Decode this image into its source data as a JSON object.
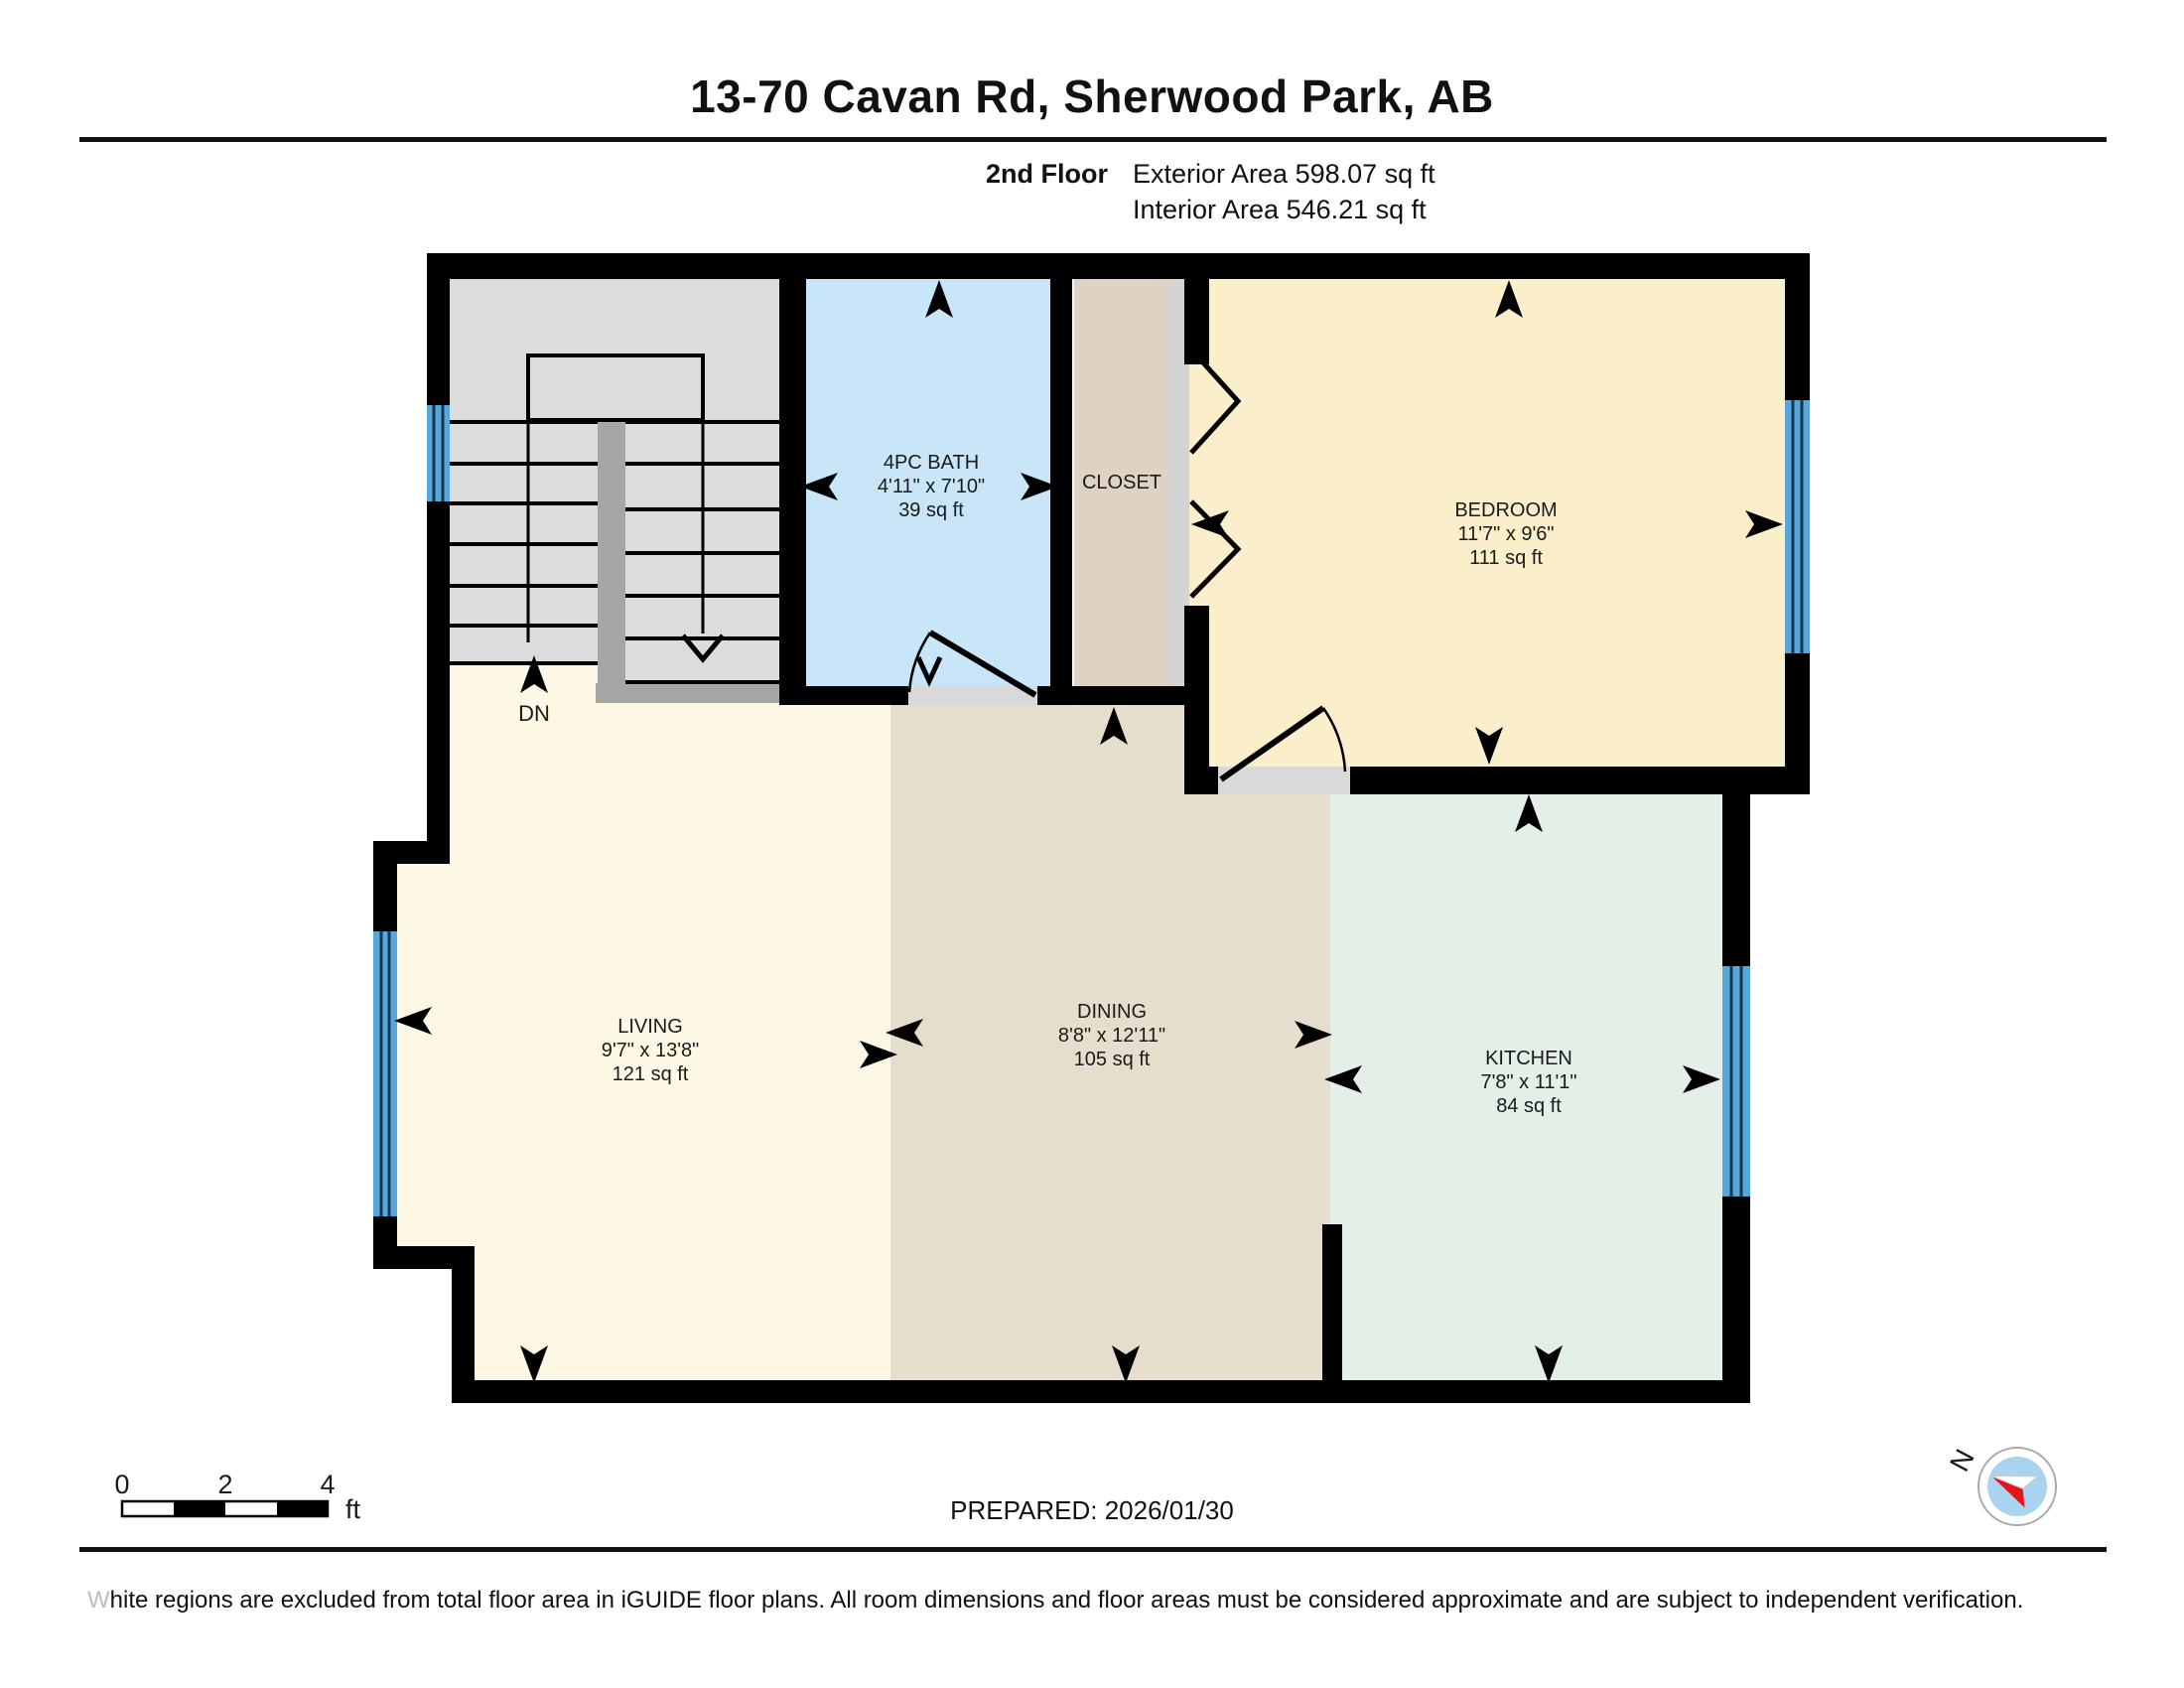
{
  "header": {
    "title": "13-70 Cavan Rd, Sherwood Park, AB",
    "floor_label": "2nd Floor",
    "exterior_area": "Exterior Area 598.07 sq ft",
    "interior_area": "Interior Area 546.21 sq ft"
  },
  "rooms": {
    "bath": {
      "name": "4PC BATH",
      "dims": "4'11\" x 7'10\"",
      "area": "39 sq ft"
    },
    "closet": {
      "name": "CLOSET"
    },
    "bedroom": {
      "name": "BEDROOM",
      "dims": "11'7\" x 9'6\"",
      "area": "111 sq ft"
    },
    "living": {
      "name": "LIVING",
      "dims": "9'7\" x 13'8\"",
      "area": "121 sq ft"
    },
    "dining": {
      "name": "DINING",
      "dims": "8'8\" x 12'11\"",
      "area": "105 sq ft"
    },
    "kitchen": {
      "name": "KITCHEN",
      "dims": "7'8\" x 11'1\"",
      "area": "84 sq ft"
    }
  },
  "stairs": {
    "down_label": "DN"
  },
  "scale_bar": {
    "ticks": [
      "0",
      "2",
      "4"
    ],
    "unit": "ft"
  },
  "compass": {
    "north_label": "N"
  },
  "footer": {
    "prepared": "PREPARED: 2026/01/30",
    "disclaimer_lead": "W",
    "disclaimer_rest": "hite regions are excluded from total floor area in iGUIDE floor plans. All room dimensions and floor areas must be considered approximate and are subject to independent verification."
  },
  "colors": {
    "wall": "#000000",
    "window": "#58a7da",
    "bath": "#c8e6f8",
    "closet": "#ded3c3",
    "closet_track": "#d4d4d4",
    "bedroom": "#faefca",
    "living": "#fdf8e6",
    "dining": "#e6decd",
    "kitchen": "#e4efe8",
    "stair": "#dcdcdc",
    "railing": "#a6a6a6",
    "threshold": "#d9d9d9",
    "compass_ring": "#aaaaaa",
    "compass_face": "#a8d4ef",
    "compass_red": "#e8121b"
  }
}
